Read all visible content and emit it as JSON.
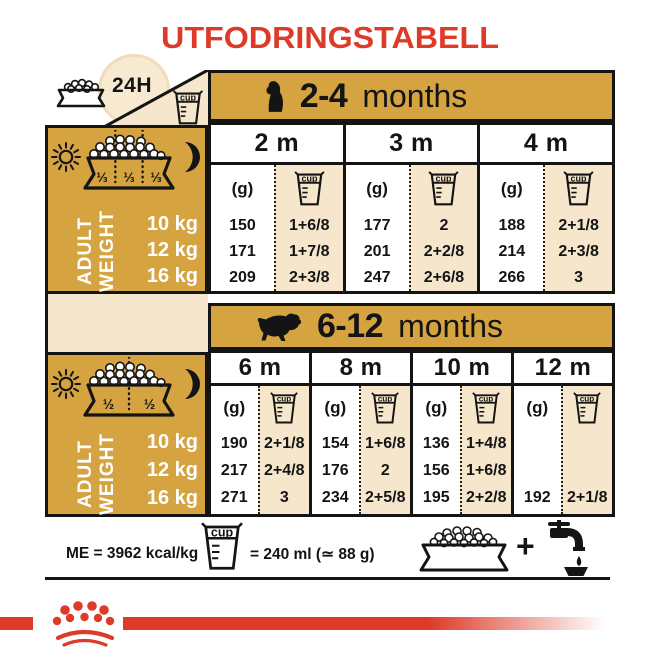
{
  "title": "UTFODRINGSTABELL",
  "labels": {
    "h24": "24H",
    "g": "(g)",
    "cup": "cup",
    "plus": "+"
  },
  "adult_weight": {
    "line1": "ADULT",
    "line2": "WEIGHT",
    "rows": [
      "10 kg",
      "12 kg",
      "16 kg"
    ]
  },
  "panels": [
    {
      "portions": [
        "⅓",
        "⅓",
        "⅓"
      ]
    },
    {
      "portions": [
        "½",
        "½"
      ]
    }
  ],
  "tables": [
    {
      "age_bold": "2-4",
      "age_rest": "months",
      "columns": [
        {
          "month": "2 m",
          "grams": [
            "150",
            "171",
            "209"
          ],
          "cups": [
            "1+6/8",
            "1+7/8",
            "2+3/8"
          ]
        },
        {
          "month": "3 m",
          "grams": [
            "177",
            "201",
            "247"
          ],
          "cups": [
            "2",
            "2+2/8",
            "2+6/8"
          ]
        },
        {
          "month": "4 m",
          "grams": [
            "188",
            "214",
            "266"
          ],
          "cups": [
            "2+1/8",
            "2+3/8",
            "3"
          ]
        }
      ]
    },
    {
      "age_bold": "6-12",
      "age_rest": "months",
      "columns": [
        {
          "month": "6 m",
          "grams": [
            "190",
            "217",
            "271"
          ],
          "cups": [
            "2+1/8",
            "2+4/8",
            "3"
          ]
        },
        {
          "month": "8 m",
          "grams": [
            "154",
            "176",
            "234"
          ],
          "cups": [
            "1+6/8",
            "2",
            "2+5/8"
          ]
        },
        {
          "month": "10 m",
          "grams": [
            "136",
            "156",
            "195"
          ],
          "cups": [
            "1+4/8",
            "1+6/8",
            "2+2/8"
          ]
        },
        {
          "month": "12 m",
          "grams": [
            "",
            "",
            "192"
          ],
          "cups": [
            "",
            "",
            "2+1/8"
          ]
        }
      ]
    }
  ],
  "footer": {
    "me": "ME = 3962 kcal/kg",
    "cup_equiv": "= 240 ml (≃ 88 g)"
  },
  "colors": {
    "gold": "#D5A33F",
    "cream": "#F6E7CC",
    "red": "#DD3A28"
  }
}
